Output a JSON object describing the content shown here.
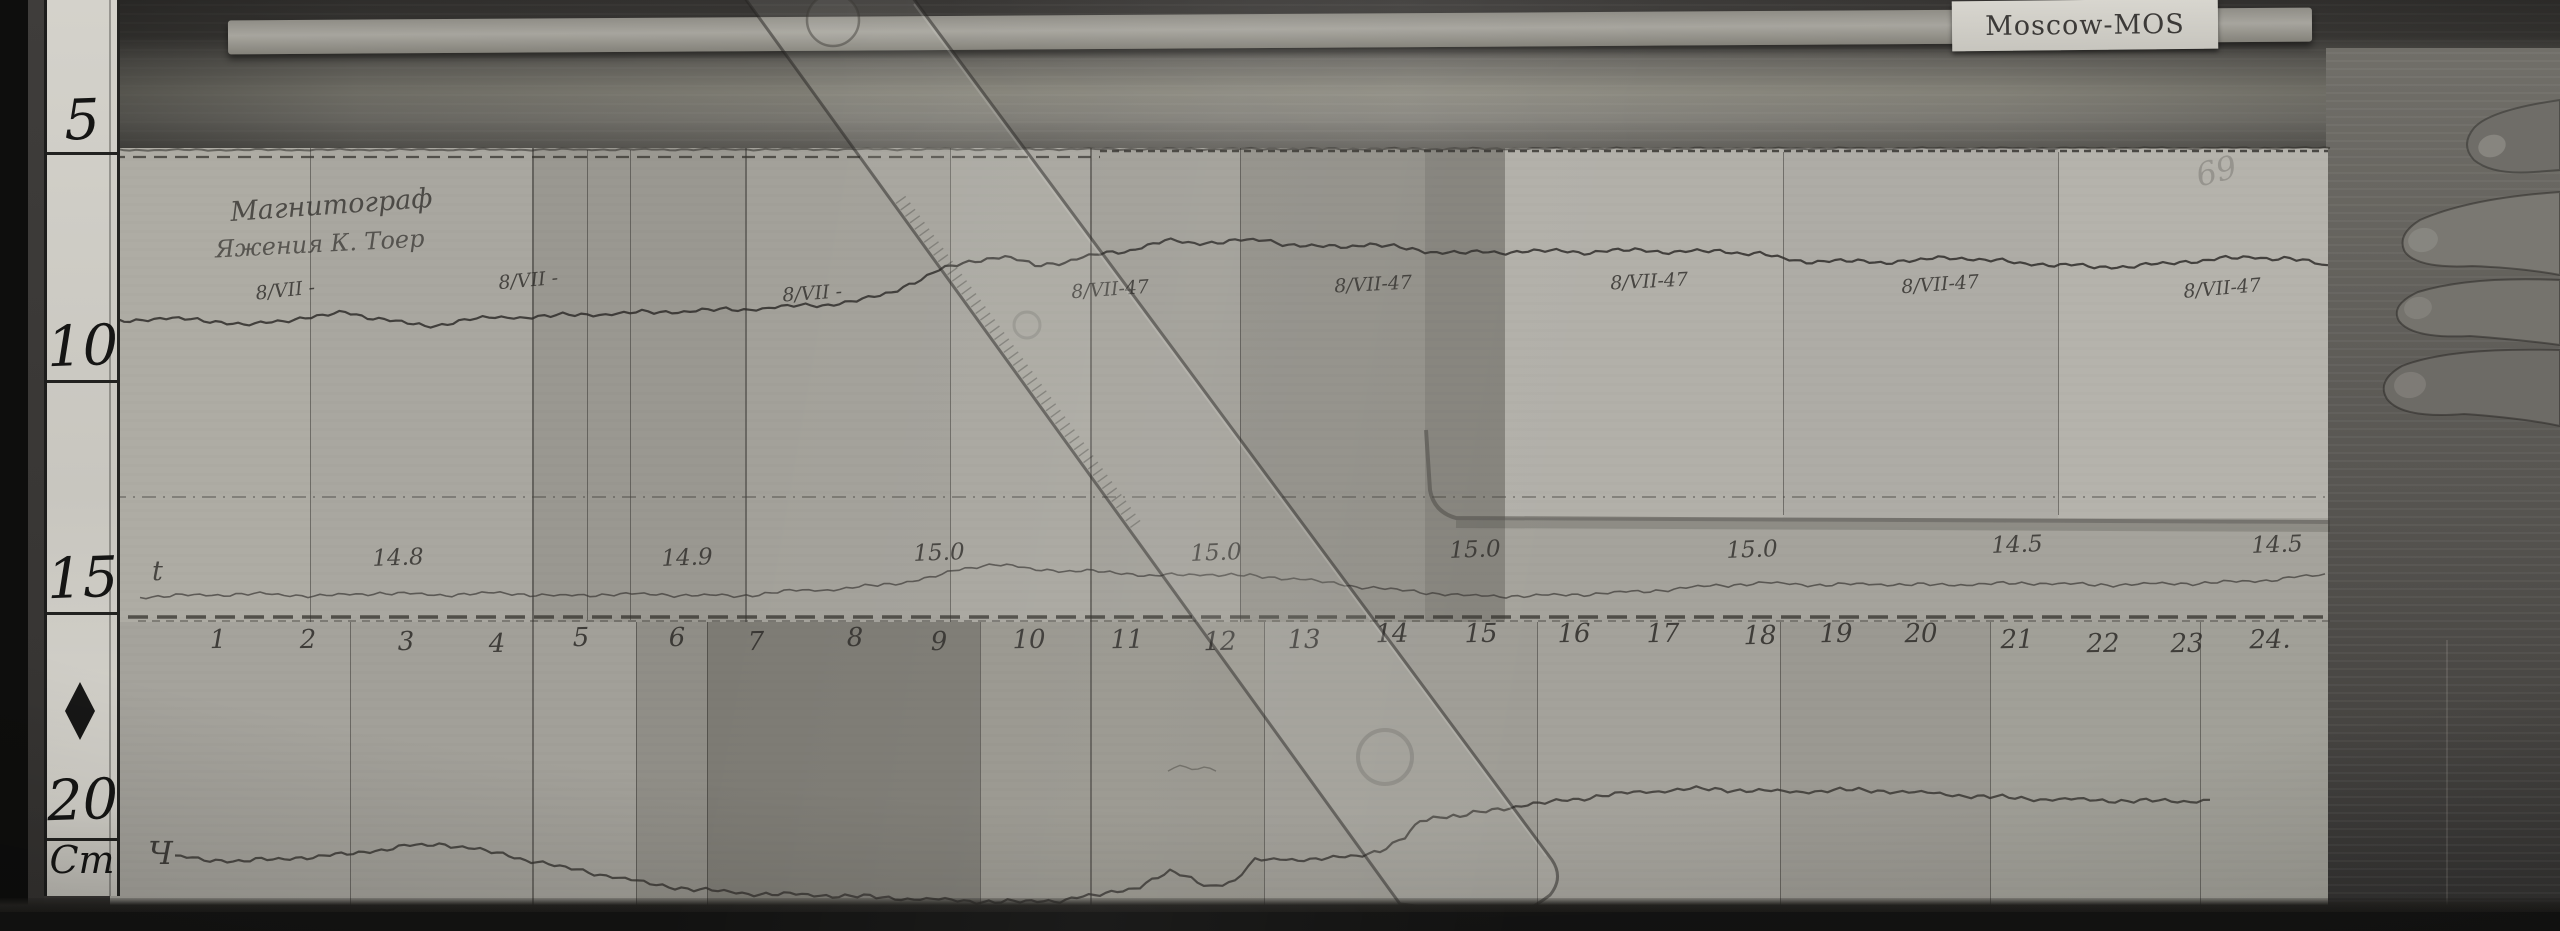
{
  "station_card": {
    "label": "Moscow-MOS"
  },
  "scale_bar": {
    "unit_label": "Cm",
    "marks": [
      {
        "label": "5",
        "y": 88
      },
      {
        "label": "10",
        "y": 314
      },
      {
        "label": "15",
        "y": 546
      },
      {
        "label": "20",
        "y": 768
      }
    ],
    "division_ys": [
      152,
      380,
      612,
      838
    ],
    "diamond_y": 682
  },
  "annotations": {
    "title_line1": "Магнитограф",
    "title_line2": "Яжения К. Тоер",
    "temp_trace_label": "t",
    "bottom_trace_label": "Ч",
    "faint_mark": "69"
  },
  "date_labels": [
    {
      "text": "8/VII -",
      "x": 285,
      "y": 288,
      "rot": -6
    },
    {
      "text": "8/VII -",
      "x": 528,
      "y": 278,
      "rot": -5
    },
    {
      "text": "8/VII -",
      "x": 812,
      "y": 291,
      "rot": -4
    },
    {
      "text": "8/VII-47",
      "x": 1110,
      "y": 287,
      "rot": -4
    },
    {
      "text": "8/VII-47",
      "x": 1373,
      "y": 282,
      "rot": -3
    },
    {
      "text": "8/VII-47",
      "x": 1649,
      "y": 279,
      "rot": -3
    },
    {
      "text": "8/VII-47",
      "x": 1940,
      "y": 282,
      "rot": -4
    },
    {
      "text": "8/VII-47",
      "x": 2222,
      "y": 286,
      "rot": -5
    }
  ],
  "value_labels": [
    {
      "text": "14.8",
      "x": 398,
      "y": 558
    },
    {
      "text": "14.9",
      "x": 687,
      "y": 558
    },
    {
      "text": "15.0",
      "x": 939,
      "y": 553
    },
    {
      "text": "15.0",
      "x": 1216,
      "y": 553
    },
    {
      "text": "15.0",
      "x": 1475,
      "y": 550
    },
    {
      "text": "15.0",
      "x": 1752,
      "y": 550
    },
    {
      "text": "14.5",
      "x": 2017,
      "y": 545
    },
    {
      "text": "14.5",
      "x": 2277,
      "y": 545
    }
  ],
  "hour_labels": [
    {
      "text": "1",
      "x": 218,
      "y": 640
    },
    {
      "text": "2",
      "x": 308,
      "y": 640
    },
    {
      "text": "3",
      "x": 406,
      "y": 642
    },
    {
      "text": "4",
      "x": 497,
      "y": 644
    },
    {
      "text": "5",
      "x": 581,
      "y": 638
    },
    {
      "text": "6",
      "x": 677,
      "y": 638
    },
    {
      "text": "7",
      "x": 756,
      "y": 642
    },
    {
      "text": "8",
      "x": 855,
      "y": 638
    },
    {
      "text": "9",
      "x": 939,
      "y": 642
    },
    {
      "text": "10",
      "x": 1029,
      "y": 640
    },
    {
      "text": "11",
      "x": 1127,
      "y": 640
    },
    {
      "text": "12",
      "x": 1220,
      "y": 642
    },
    {
      "text": "13",
      "x": 1304,
      "y": 640
    },
    {
      "text": "14",
      "x": 1392,
      "y": 634
    },
    {
      "text": "15",
      "x": 1481,
      "y": 634
    },
    {
      "text": "16",
      "x": 1574,
      "y": 634
    },
    {
      "text": "17",
      "x": 1663,
      "y": 634
    },
    {
      "text": "18",
      "x": 1760,
      "y": 636
    },
    {
      "text": "19",
      "x": 1836,
      "y": 634
    },
    {
      "text": "20",
      "x": 1921,
      "y": 634
    },
    {
      "text": "21",
      "x": 2017,
      "y": 640
    },
    {
      "text": "22",
      "x": 2103,
      "y": 644
    },
    {
      "text": "23",
      "x": 2187,
      "y": 644
    },
    {
      "text": "24.",
      "x": 2270,
      "y": 640
    }
  ],
  "sheets": {
    "tones": [
      {
        "x": 110,
        "y": 148,
        "w": 200,
        "h": 474,
        "c": "#aeaca4"
      },
      {
        "x": 310,
        "y": 148,
        "w": 222,
        "h": 474,
        "c": "#a9a7a0"
      },
      {
        "x": 532,
        "y": 148,
        "w": 213,
        "h": 474,
        "c": "#9a9891"
      },
      {
        "x": 745,
        "y": 148,
        "w": 205,
        "h": 474,
        "c": "#a3a19a"
      },
      {
        "x": 950,
        "y": 148,
        "w": 140,
        "h": 474,
        "c": "#a9a7a0"
      },
      {
        "x": 1090,
        "y": 148,
        "w": 150,
        "h": 474,
        "c": "#a2a099"
      },
      {
        "x": 1240,
        "y": 148,
        "w": 185,
        "h": 474,
        "c": "#93918a"
      },
      {
        "x": 1425,
        "y": 148,
        "w": 80,
        "h": 474,
        "c": "#86847d"
      },
      {
        "x": 1505,
        "y": 148,
        "w": 278,
        "h": 370,
        "c": "#b2b0a9"
      },
      {
        "x": 1783,
        "y": 148,
        "w": 275,
        "h": 370,
        "c": "#aeaca6"
      },
      {
        "x": 2058,
        "y": 148,
        "w": 270,
        "h": 370,
        "c": "#b5b3ac"
      },
      {
        "x": 1505,
        "y": 518,
        "w": 823,
        "h": 104,
        "c": "#a5a39c"
      },
      {
        "x": 110,
        "y": 622,
        "w": 240,
        "h": 286,
        "c": "#a5a39c"
      },
      {
        "x": 350,
        "y": 622,
        "w": 286,
        "h": 286,
        "c": "#a2a099"
      },
      {
        "x": 636,
        "y": 622,
        "w": 71,
        "h": 286,
        "c": "#908e87"
      },
      {
        "x": 707,
        "y": 622,
        "w": 273,
        "h": 286,
        "c": "#7d7b74"
      },
      {
        "x": 980,
        "y": 622,
        "w": 284,
        "h": 286,
        "c": "#99978f"
      },
      {
        "x": 1264,
        "y": 622,
        "w": 273,
        "h": 286,
        "c": "#9f9d96"
      },
      {
        "x": 1537,
        "y": 622,
        "w": 243,
        "h": 286,
        "c": "#a4a29b"
      },
      {
        "x": 1780,
        "y": 622,
        "w": 210,
        "h": 286,
        "c": "#9b9992"
      },
      {
        "x": 1990,
        "y": 622,
        "w": 338,
        "h": 286,
        "c": "#a1a098"
      }
    ],
    "fold_lines": [
      {
        "x": 310,
        "y1": 148,
        "y2": 622,
        "w": 1
      },
      {
        "x": 532,
        "y1": 148,
        "y2": 908,
        "w": 2
      },
      {
        "x": 587,
        "y1": 150,
        "y2": 620,
        "w": 1
      },
      {
        "x": 630,
        "y1": 150,
        "y2": 620,
        "w": 1
      },
      {
        "x": 745,
        "y1": 148,
        "y2": 622,
        "w": 2
      },
      {
        "x": 950,
        "y1": 148,
        "y2": 622,
        "w": 1
      },
      {
        "x": 1090,
        "y1": 148,
        "y2": 908,
        "w": 2
      },
      {
        "x": 1240,
        "y1": 148,
        "y2": 622,
        "w": 1
      },
      {
        "x": 1783,
        "y1": 152,
        "y2": 515,
        "w": 1
      },
      {
        "x": 2058,
        "y1": 152,
        "y2": 515,
        "w": 1
      },
      {
        "x": 350,
        "y1": 622,
        "y2": 908,
        "w": 1
      },
      {
        "x": 636,
        "y1": 622,
        "y2": 908,
        "w": 1
      },
      {
        "x": 707,
        "y1": 622,
        "y2": 908,
        "w": 1
      },
      {
        "x": 980,
        "y1": 622,
        "y2": 908,
        "w": 1
      },
      {
        "x": 1264,
        "y1": 622,
        "y2": 908,
        "w": 1
      },
      {
        "x": 1537,
        "y1": 622,
        "y2": 908,
        "w": 1
      },
      {
        "x": 1780,
        "y1": 622,
        "y2": 908,
        "w": 1
      },
      {
        "x": 1990,
        "y1": 622,
        "y2": 908,
        "w": 1
      },
      {
        "x": 2200,
        "y1": 622,
        "y2": 908,
        "w": 1
      }
    ]
  },
  "traces": {
    "declination": [
      [
        112,
        322
      ],
      [
        160,
        318
      ],
      [
        210,
        321
      ],
      [
        255,
        325
      ],
      [
        300,
        318
      ],
      [
        345,
        313
      ],
      [
        390,
        320
      ],
      [
        425,
        327
      ],
      [
        470,
        319
      ],
      [
        520,
        317
      ],
      [
        575,
        315
      ],
      [
        630,
        313
      ],
      [
        690,
        311
      ],
      [
        750,
        309
      ],
      [
        800,
        306
      ],
      [
        845,
        303
      ],
      [
        880,
        296
      ],
      [
        915,
        282
      ],
      [
        945,
        268
      ],
      [
        975,
        260
      ],
      [
        1005,
        257
      ],
      [
        1035,
        265
      ],
      [
        1065,
        262
      ],
      [
        1095,
        255
      ],
      [
        1130,
        250
      ],
      [
        1165,
        241
      ],
      [
        1200,
        243
      ],
      [
        1235,
        241
      ],
      [
        1265,
        240
      ],
      [
        1300,
        246
      ],
      [
        1335,
        247
      ],
      [
        1370,
        244
      ],
      [
        1400,
        248
      ],
      [
        1425,
        251
      ],
      [
        1460,
        253
      ],
      [
        1500,
        252
      ],
      [
        1545,
        251
      ],
      [
        1590,
        252
      ],
      [
        1635,
        250
      ],
      [
        1680,
        252
      ],
      [
        1720,
        251
      ],
      [
        1760,
        254
      ],
      [
        1795,
        261
      ],
      [
        1835,
        261
      ],
      [
        1875,
        262
      ],
      [
        1915,
        261
      ],
      [
        1950,
        257
      ],
      [
        1985,
        260
      ],
      [
        2020,
        263
      ],
      [
        2060,
        265
      ],
      [
        2100,
        267
      ],
      [
        2140,
        266
      ],
      [
        2180,
        262
      ],
      [
        2220,
        259
      ],
      [
        2255,
        257
      ],
      [
        2290,
        259
      ],
      [
        2315,
        263
      ],
      [
        2328,
        266
      ]
    ],
    "temperature": [
      [
        140,
        597
      ],
      [
        200,
        595
      ],
      [
        260,
        594
      ],
      [
        320,
        596
      ],
      [
        380,
        593
      ],
      [
        440,
        595
      ],
      [
        500,
        593
      ],
      [
        560,
        596
      ],
      [
        620,
        594
      ],
      [
        680,
        595
      ],
      [
        740,
        596
      ],
      [
        790,
        591
      ],
      [
        840,
        589
      ],
      [
        890,
        584
      ],
      [
        930,
        578
      ],
      [
        965,
        568
      ],
      [
        995,
        564
      ],
      [
        1030,
        569
      ],
      [
        1070,
        571
      ],
      [
        1110,
        572
      ],
      [
        1155,
        576
      ],
      [
        1200,
        574
      ],
      [
        1250,
        576
      ],
      [
        1300,
        579
      ],
      [
        1345,
        585
      ],
      [
        1385,
        589
      ],
      [
        1420,
        592
      ],
      [
        1470,
        596
      ],
      [
        1530,
        596
      ],
      [
        1590,
        594
      ],
      [
        1650,
        591
      ],
      [
        1710,
        586
      ],
      [
        1765,
        583
      ],
      [
        1820,
        585
      ],
      [
        1875,
        584
      ],
      [
        1930,
        585
      ],
      [
        1985,
        584
      ],
      [
        2040,
        583
      ],
      [
        2095,
        585
      ],
      [
        2150,
        584
      ],
      [
        2205,
        583
      ],
      [
        2255,
        581
      ],
      [
        2300,
        577
      ],
      [
        2325,
        575
      ]
    ],
    "vertical": [
      [
        175,
        857
      ],
      [
        210,
        860
      ],
      [
        250,
        861
      ],
      [
        290,
        858
      ],
      [
        330,
        856
      ],
      [
        370,
        851
      ],
      [
        410,
        846
      ],
      [
        445,
        844
      ],
      [
        480,
        850
      ],
      [
        520,
        858
      ],
      [
        560,
        867
      ],
      [
        600,
        874
      ],
      [
        650,
        884
      ],
      [
        700,
        890
      ],
      [
        760,
        894
      ],
      [
        820,
        895
      ],
      [
        870,
        897
      ],
      [
        920,
        899
      ],
      [
        970,
        901
      ],
      [
        1020,
        902
      ],
      [
        1060,
        900
      ],
      [
        1100,
        895
      ],
      [
        1140,
        886
      ],
      [
        1170,
        872
      ],
      [
        1185,
        876
      ],
      [
        1210,
        886
      ],
      [
        1235,
        882
      ],
      [
        1255,
        860
      ],
      [
        1280,
        858
      ],
      [
        1310,
        861
      ],
      [
        1345,
        856
      ],
      [
        1380,
        852
      ],
      [
        1405,
        838
      ],
      [
        1420,
        820
      ],
      [
        1440,
        816
      ],
      [
        1460,
        817
      ],
      [
        1480,
        812
      ],
      [
        1510,
        807
      ],
      [
        1545,
        803
      ],
      [
        1590,
        797
      ],
      [
        1640,
        792
      ],
      [
        1690,
        789
      ],
      [
        1740,
        790
      ],
      [
        1790,
        792
      ],
      [
        1840,
        790
      ],
      [
        1890,
        791
      ],
      [
        1940,
        794
      ],
      [
        1990,
        797
      ],
      [
        2040,
        799
      ],
      [
        2090,
        800
      ],
      [
        2140,
        801
      ],
      [
        2190,
        801
      ],
      [
        2210,
        800
      ]
    ],
    "fragment": [
      [
        1168,
        772
      ],
      [
        1180,
        765
      ],
      [
        1192,
        770
      ],
      [
        1204,
        766
      ],
      [
        1216,
        771
      ]
    ],
    "sheet_top_edge": {
      "x1": 112,
      "x2": 2330,
      "y": 150
    },
    "baseline_top_left": {
      "x1": 112,
      "x2": 1100,
      "y": 157
    },
    "baseline_top_right": {
      "x1": 1100,
      "x2": 2328,
      "y": 151
    },
    "mid_dashdot": {
      "x1": 112,
      "x2": 2328,
      "y": 497
    },
    "hour_line": {
      "x1": 128,
      "x2": 2330,
      "y": 617
    }
  }
}
